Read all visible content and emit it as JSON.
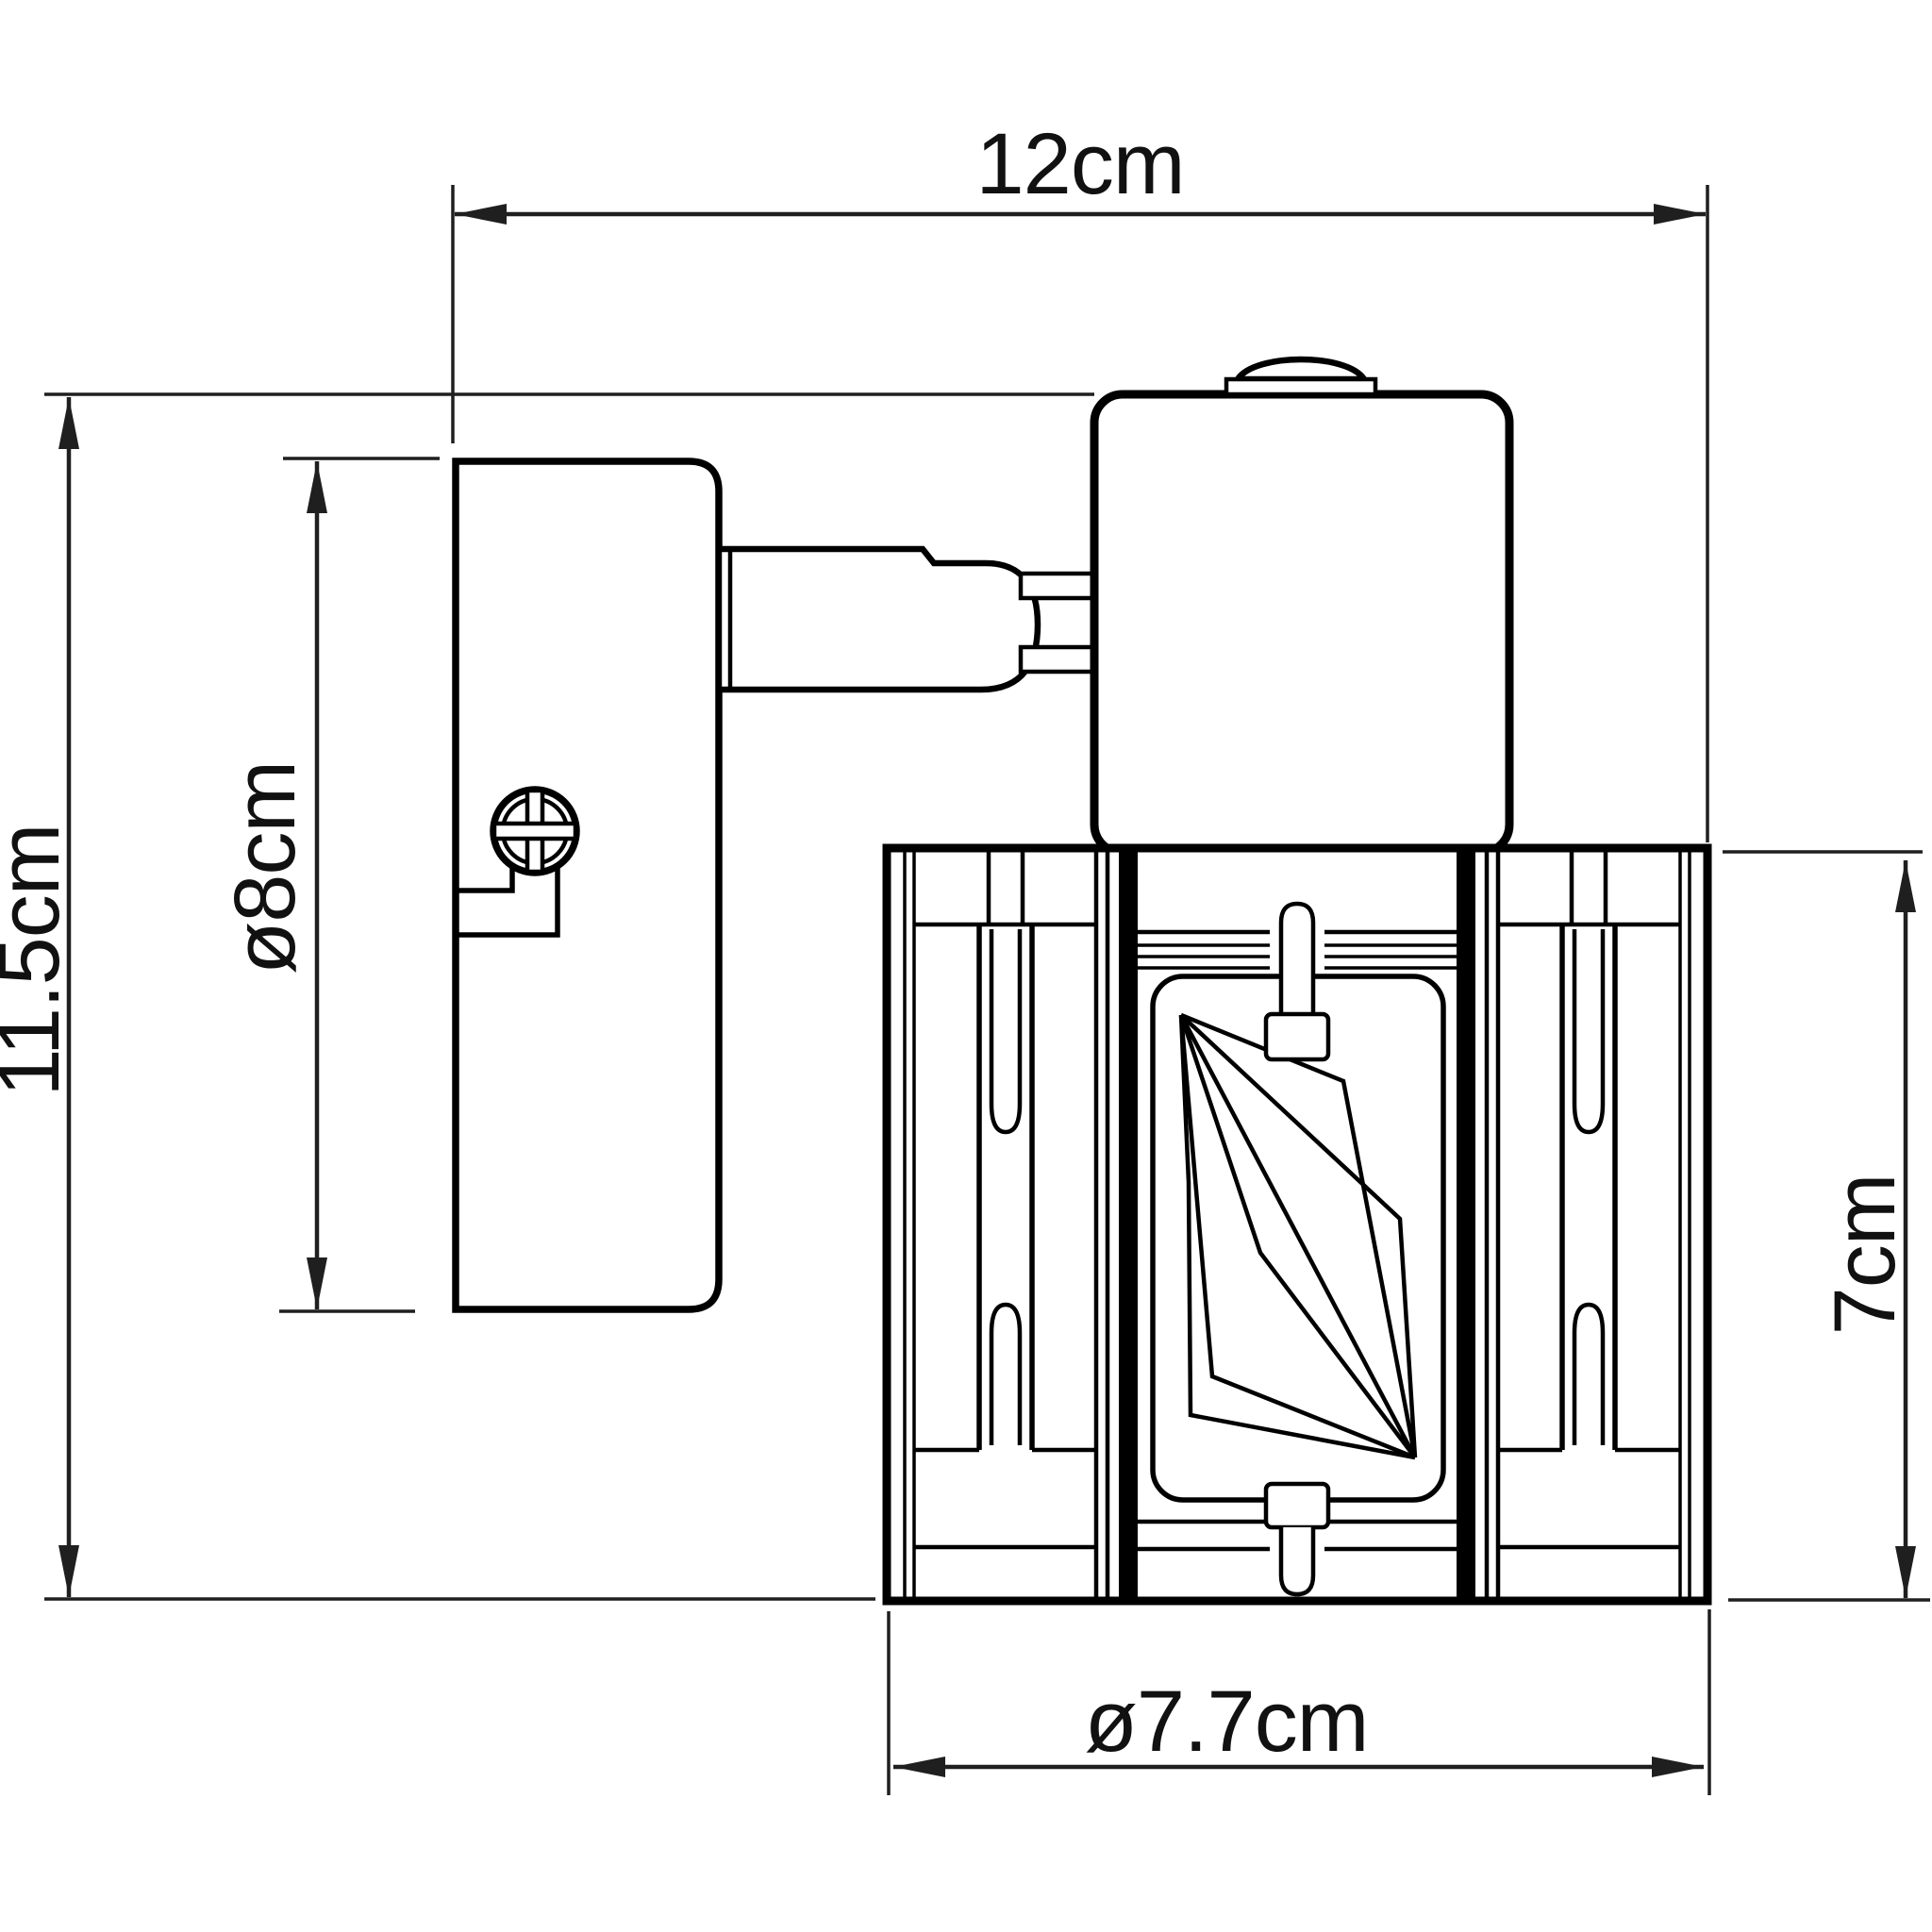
{
  "drawing": {
    "title": "wall spotlight technical line drawing, side elevation",
    "units": "cm",
    "colors": {
      "background": "#ffffff",
      "ink": "#000000",
      "dimension": "#1f1f1f"
    },
    "dimensions": {
      "overall_width": {
        "label": "12cm",
        "orientation": "horizontal-top"
      },
      "overall_height": {
        "label": "11.5cm",
        "orientation": "vertical-left"
      },
      "backplate_diameter": {
        "label": "ø8cm",
        "orientation": "vertical-inner-left"
      },
      "shade_height": {
        "label": "7cm",
        "orientation": "vertical-right"
      },
      "shade_diameter": {
        "label": "ø7.7cm",
        "orientation": "horizontal-bottom"
      }
    },
    "parts": [
      "wall-backplate",
      "phillips-screw",
      "pivot-arm",
      "lamp-body",
      "switch-button",
      "lamp-shade",
      "crystal-panel",
      "hanger-hooks"
    ]
  }
}
